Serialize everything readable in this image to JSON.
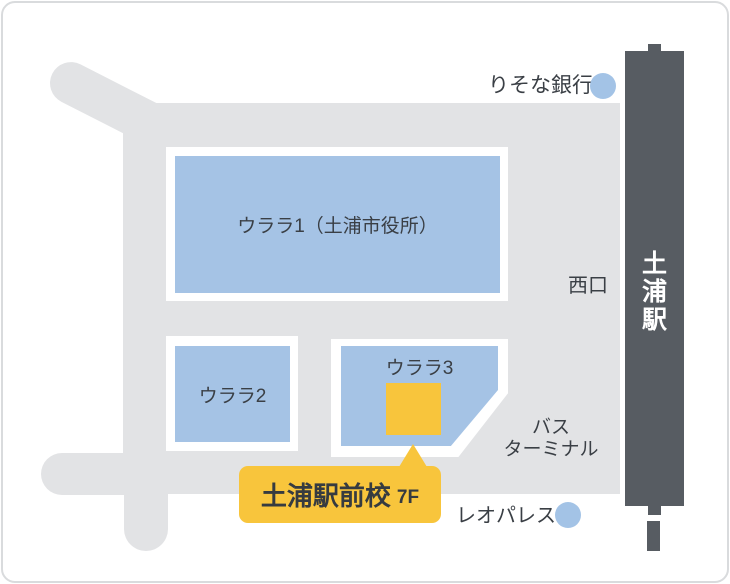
{
  "colors": {
    "road": "#e2e3e5",
    "building": "#a5c3e5",
    "station": "#575c62",
    "accent_yellow": "#f8c53c",
    "marker_blue": "#a3c3e6",
    "text": "#3a3f45",
    "card_border": "#d9dbdd"
  },
  "buildings": [
    {
      "label": "ウララ1（土浦市役所）"
    },
    {
      "label": "ウララ2"
    },
    {
      "label": "ウララ3"
    }
  ],
  "station": {
    "name": "土浦駅"
  },
  "landmarks": {
    "bank": {
      "label": "りそな銀行"
    },
    "west_exit": {
      "label": "西口"
    },
    "bus_terminal": {
      "line1": "バス",
      "line2": "ターミナル"
    },
    "leopalace": {
      "label": "レオパレス"
    }
  },
  "callout": {
    "name": "土浦駅前校",
    "floor": "7F"
  }
}
